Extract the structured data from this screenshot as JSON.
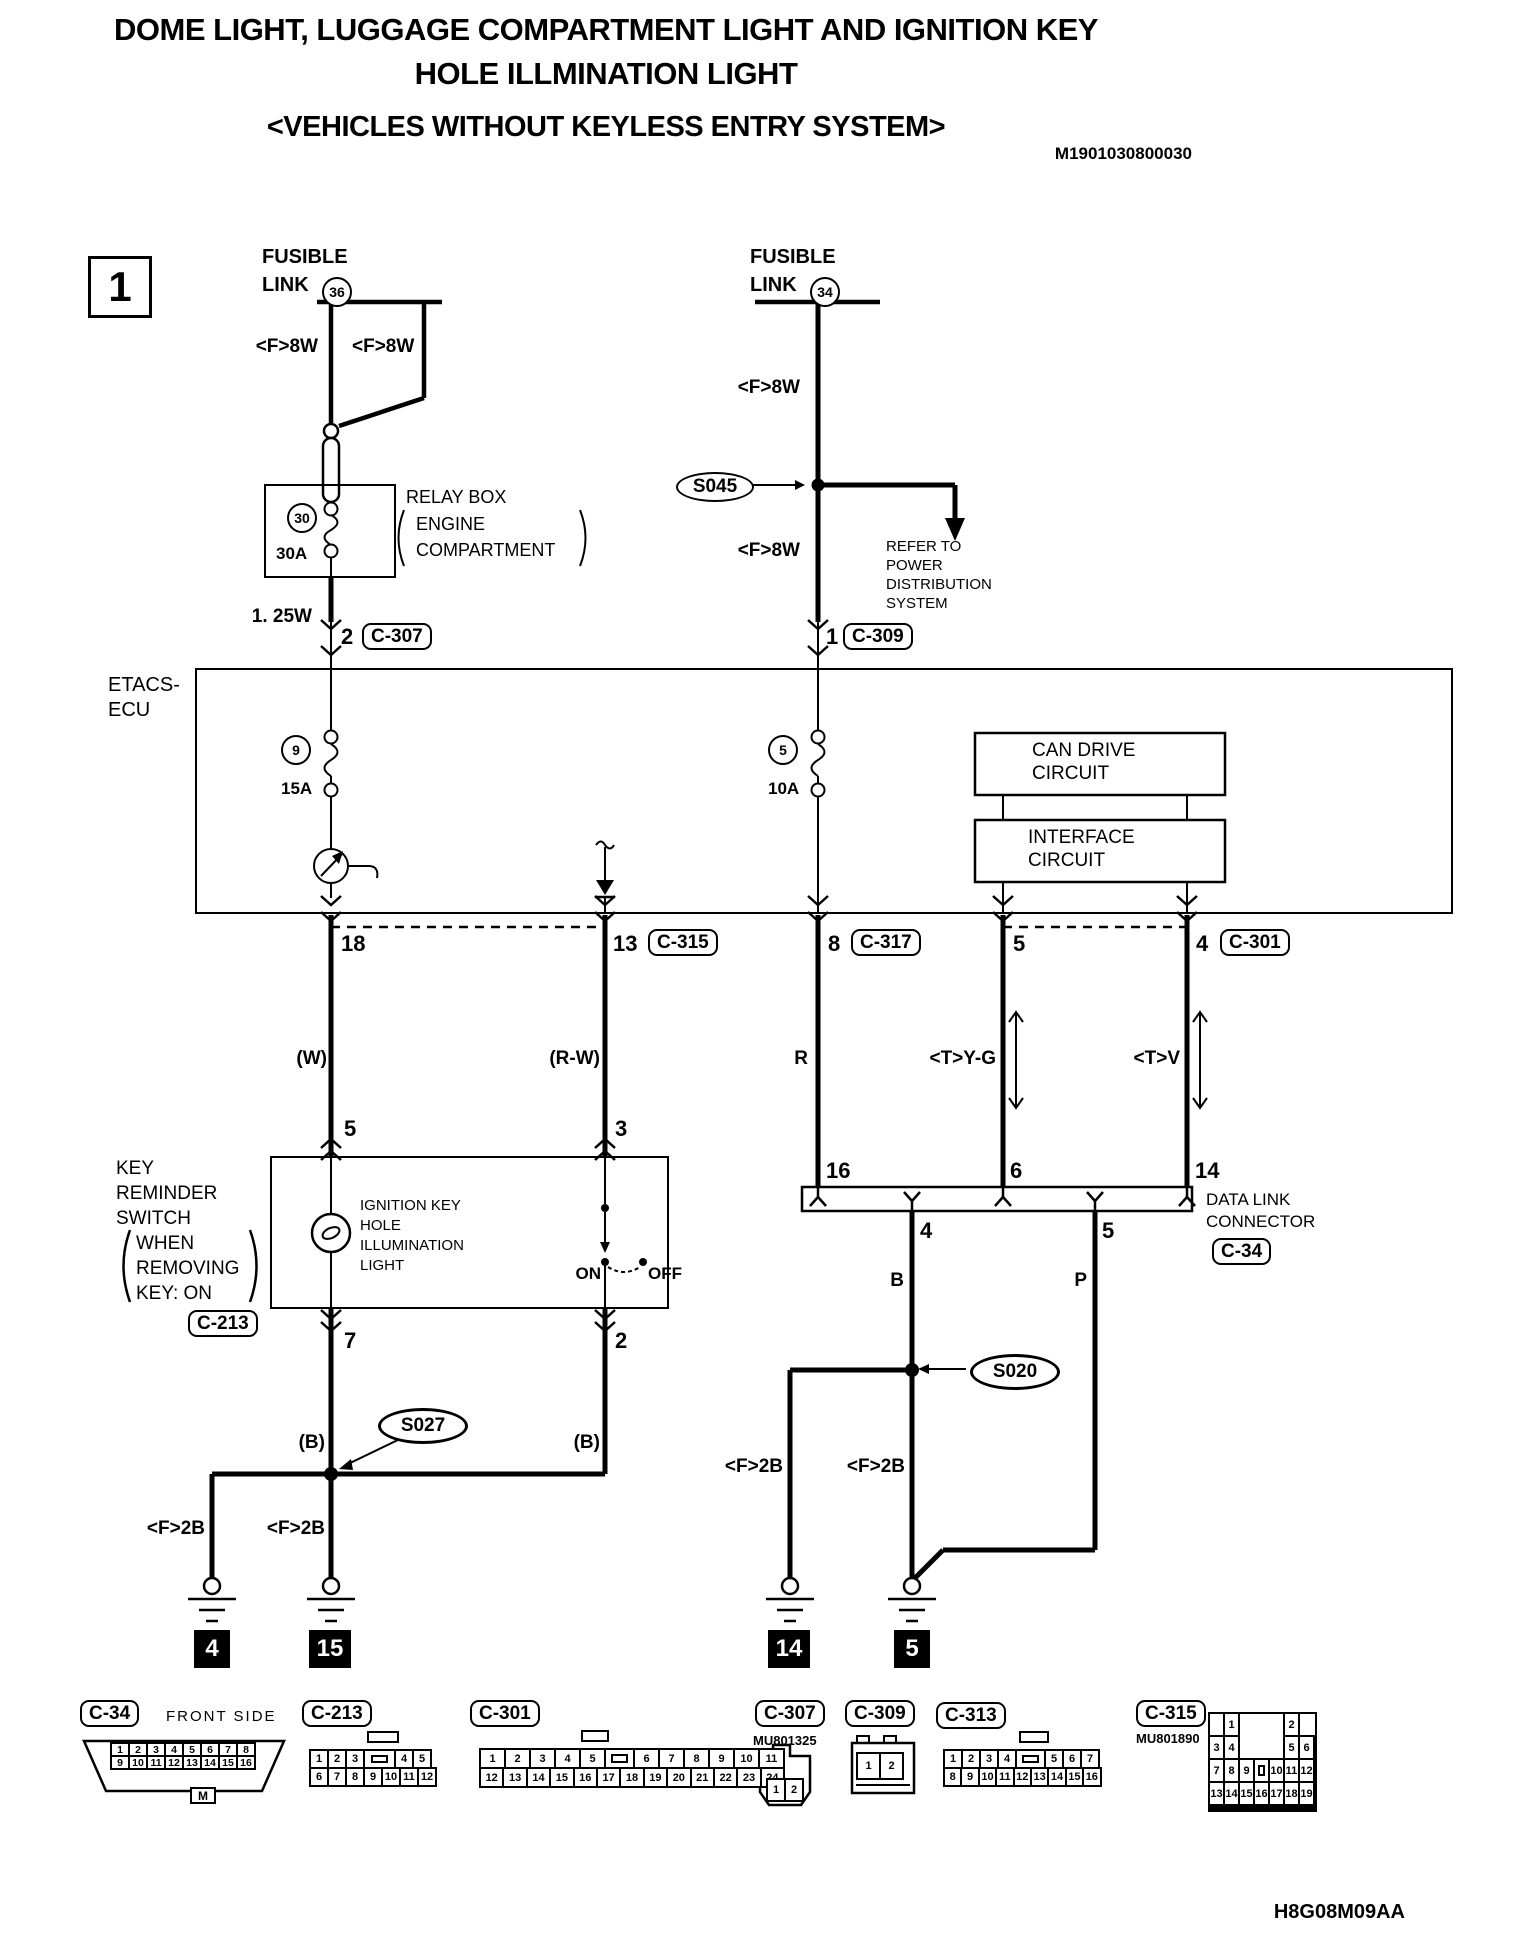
{
  "title": {
    "line1": "DOME LIGHT, LUGGAGE COMPARTMENT LIGHT AND IGNITION KEY",
    "line2": "HOLE ILLMINATION LIGHT",
    "subtitle": "<VEHICLES WITHOUT KEYLESS ENTRY SYSTEM>",
    "doc_number": "M1901030800030",
    "section": "1",
    "footer_code": "H8G08M09AA"
  },
  "labels": {
    "f8w": "<F>8W",
    "f2b": "<F>2B",
    "w125": "1. 25W",
    "refer": [
      "REFER TO",
      "POWER",
      "DISTRIBUTION",
      "SYSTEM"
    ]
  },
  "fusible_left": {
    "line1": "FUSIBLE",
    "line2": "LINK",
    "num": "36"
  },
  "fusible_right": {
    "line1": "FUSIBLE",
    "line2": "LINK",
    "num": "34"
  },
  "relay": {
    "num": "30",
    "amp": "30A",
    "name": "RELAY BOX",
    "loc1": "ENGINE",
    "loc2": "COMPARTMENT"
  },
  "etacs": {
    "name1": "ETACS-",
    "name2": "ECU",
    "fuse_left_num": "9",
    "fuse_left_amp": "15A",
    "fuse_right_num": "5",
    "fuse_right_amp": "10A",
    "can1": "CAN DRIVE",
    "can2": "CIRCUIT",
    "if1": "INTERFACE",
    "if2": "CIRCUIT"
  },
  "splices": {
    "s045": "S045",
    "s027": "S027",
    "s020": "S020"
  },
  "pins": {
    "p2": "2",
    "p1": "1",
    "p18": "18",
    "p13": "13",
    "p8": "8",
    "p5": "5",
    "p4": "4",
    "k5": "5",
    "k3": "3",
    "k7": "7",
    "k2": "2",
    "d16": "16",
    "d6": "6",
    "d14": "14",
    "d4": "4",
    "d5": "5"
  },
  "badges": {
    "c307": "C-307",
    "c309": "C-309",
    "c315": "C-315",
    "c317": "C-317",
    "c301": "C-301",
    "c213": "C-213",
    "c34": "C-34"
  },
  "wires": {
    "w": "(W)",
    "rw": "(R-W)",
    "r": "R",
    "yg": "<T>Y-G",
    "v": "<T>V",
    "b_left": "(B)",
    "b_right": "(B)",
    "b": "B",
    "p": "P"
  },
  "key_switch": {
    "lines": [
      "KEY",
      "REMINDER",
      "SWITCH",
      "WHEN",
      "REMOVING",
      "KEY: ON"
    ],
    "light": [
      "IGNITION KEY",
      "HOLE",
      "ILLUMINATION",
      "LIGHT"
    ],
    "on": "ON",
    "off": "OFF"
  },
  "dlc": {
    "line1": "DATA LINK",
    "line2": "CONNECTOR"
  },
  "grounds": {
    "g4": "4",
    "g15": "15",
    "g14": "14",
    "g5": "5"
  },
  "footer_connectors": [
    {
      "id": "C-34",
      "note": "FRONT SIDE",
      "bottom_tab": "M",
      "rows": [
        [
          "1",
          "2",
          "3",
          "4",
          "5",
          "6",
          "7",
          "8"
        ],
        [
          "9",
          "10",
          "11",
          "12",
          "13",
          "14",
          "15",
          "16"
        ]
      ]
    },
    {
      "id": "C-213",
      "rows": [
        [
          "1",
          "2",
          "3",
          "TAB",
          "4",
          "5"
        ],
        [
          "6",
          "7",
          "8",
          "9",
          "10",
          "11",
          "12"
        ]
      ]
    },
    {
      "id": "C-301",
      "rows": [
        [
          "1",
          "2",
          "3",
          "4",
          "5",
          "TAB",
          "6",
          "7",
          "8",
          "9",
          "10",
          "11"
        ],
        [
          "12",
          "13",
          "14",
          "15",
          "16",
          "17",
          "18",
          "19",
          "20",
          "21",
          "22",
          "23",
          "24"
        ]
      ]
    },
    {
      "id": "C-307",
      "code": "MU801325",
      "rows": [
        [
          "1",
          "2"
        ]
      ]
    },
    {
      "id": "C-309",
      "rows": [
        [
          "1",
          "2"
        ]
      ]
    },
    {
      "id": "C-313",
      "rows": [
        [
          "1",
          "2",
          "3",
          "4",
          "TAB",
          "5",
          "6",
          "7"
        ],
        [
          "8",
          "9",
          "10",
          "11",
          "12",
          "13",
          "14",
          "15",
          "16"
        ]
      ]
    },
    {
      "id": "C-315",
      "code": "MU801890",
      "rows": [
        [
          "",
          "1",
          "",
          "",
          "",
          "2",
          ""
        ],
        [
          "3",
          "4",
          "",
          "",
          "",
          "5",
          "6"
        ],
        [
          "7",
          "8",
          "9",
          "TAB",
          "10",
          "11",
          "12"
        ],
        [
          "13",
          "14",
          "15",
          "16",
          "17",
          "18",
          "19"
        ]
      ]
    }
  ]
}
